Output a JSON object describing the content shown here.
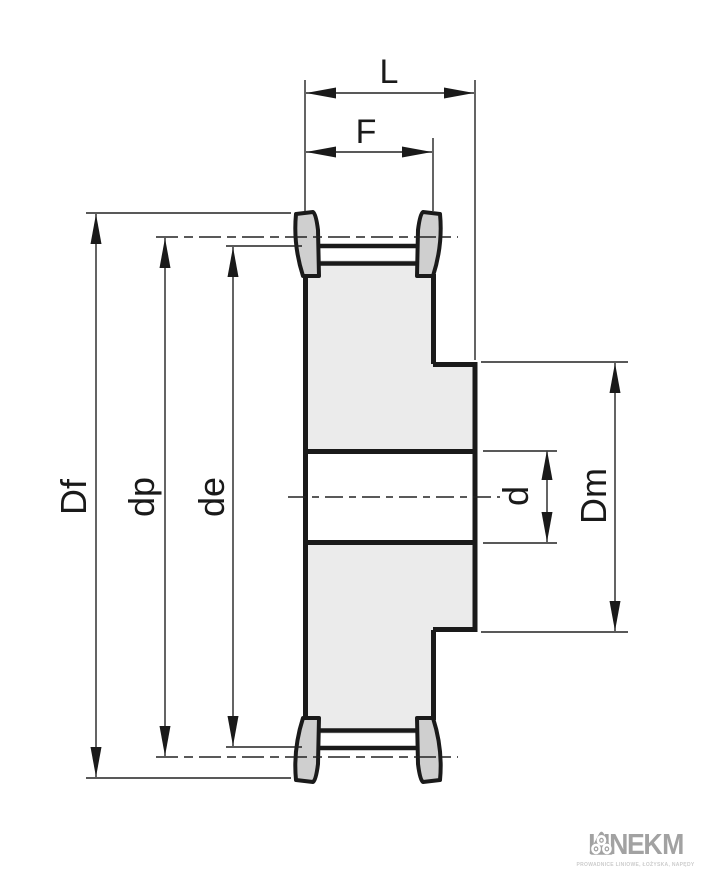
{
  "drawing": {
    "type": "technical-drawing",
    "subject": "toothed timing-belt pulley with flanges, cross-section with dimension lines",
    "dim_labels": {
      "L": "L",
      "F": "F",
      "Df": "Df",
      "dp": "dp",
      "de": "de",
      "d": "d",
      "Dm": "Dm"
    },
    "colors": {
      "line": "#1a1a1a",
      "body_fill": "#ebebeb",
      "flange_fill": "#cfcfcf",
      "bore_fill": "#ffffff",
      "background": "#ffffff"
    }
  },
  "logo": {
    "brand_left": "LINEK",
    "brand_right": "M",
    "icon": "pulley-rollers-triangle-icon",
    "brand_color": "#a2a2a2",
    "tagline": "PROWADNICE LINIOWE, ŁOŻYSKA, NAPĘDY"
  }
}
